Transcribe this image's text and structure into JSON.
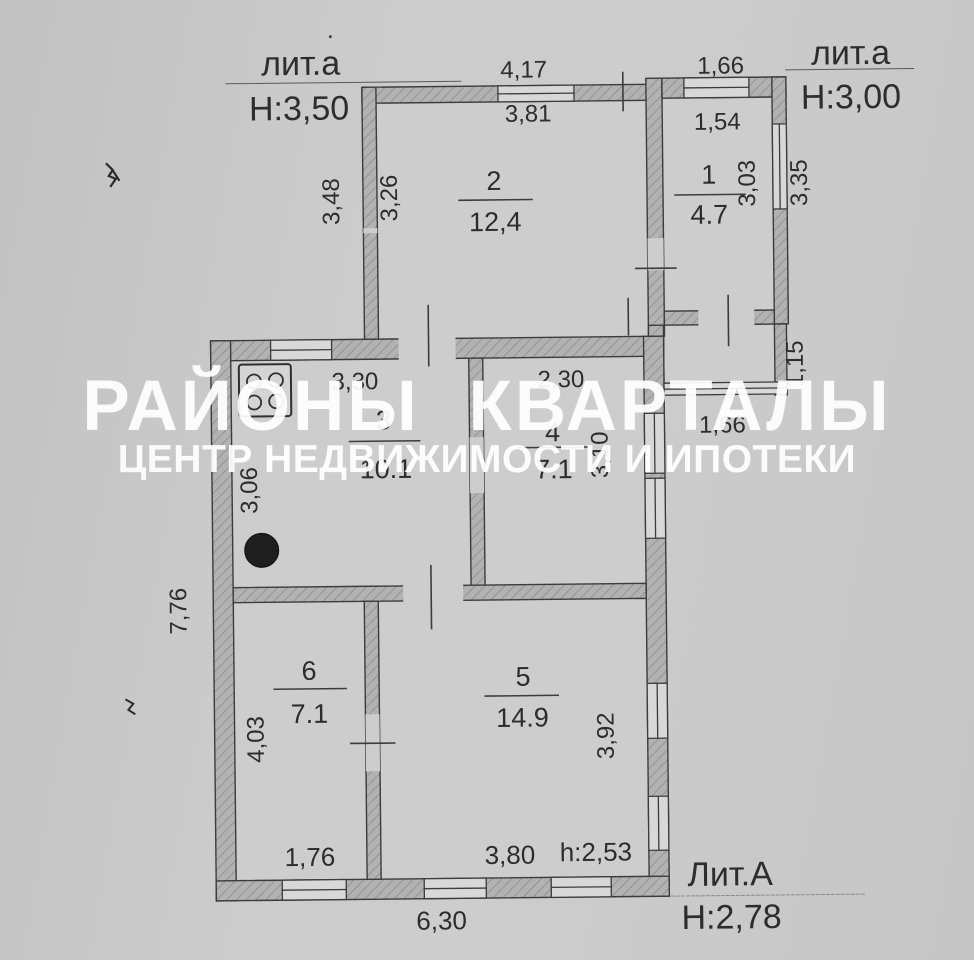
{
  "watermark": {
    "line1": "РАЙОНЫ КВАРТАЛЫ",
    "line2": "ЦЕНТР НЕДВИЖИМОСТИ И ИПОТЕКИ"
  },
  "blocks": {
    "annex_top_left": {
      "label": "лит.а",
      "height": "Н:3,50"
    },
    "annex_top_right": {
      "label": "лит.а",
      "height": "Н:3,00"
    },
    "main_building": {
      "label": "Лит.А",
      "height": "Н:2,78",
      "ceiling_note": "h:2,53"
    }
  },
  "rooms": {
    "r1": {
      "num": "1",
      "area": "4.7"
    },
    "r2": {
      "num": "2",
      "area": "12,4"
    },
    "r3": {
      "num": "3",
      "area": "10.1"
    },
    "r4": {
      "num": "4",
      "area": "7.1"
    },
    "r5": {
      "num": "5",
      "area": "14.9"
    },
    "r6": {
      "num": "6",
      "area": "7.1"
    }
  },
  "dims": {
    "top_left_width": "4,17",
    "top_right_width": "1,66",
    "r2_inner_width": "3,81",
    "r1_inner_width": "1,54",
    "r2_outer_height": "3,48",
    "r2_inner_height": "3,26",
    "r1_inner_height": "3,03",
    "r1_outer_height": "3,35",
    "porch_height": "1,15",
    "porch_width": "1,66",
    "r3_width": "3,30",
    "r3_height": "3,06",
    "r4_width": "2,30",
    "r4_height": "3,10",
    "left_total_height": "7,76",
    "r6_height": "4,03",
    "r6_width": "1,76",
    "r5_height": "3,92",
    "r5_width": "3,80",
    "bottom_total_width": "6,30"
  },
  "colors": {
    "paper": "#c9c9c9",
    "ink": "#2d2d2d",
    "wall_fill": "#b0b0b0",
    "watermark": "#ffffff"
  }
}
